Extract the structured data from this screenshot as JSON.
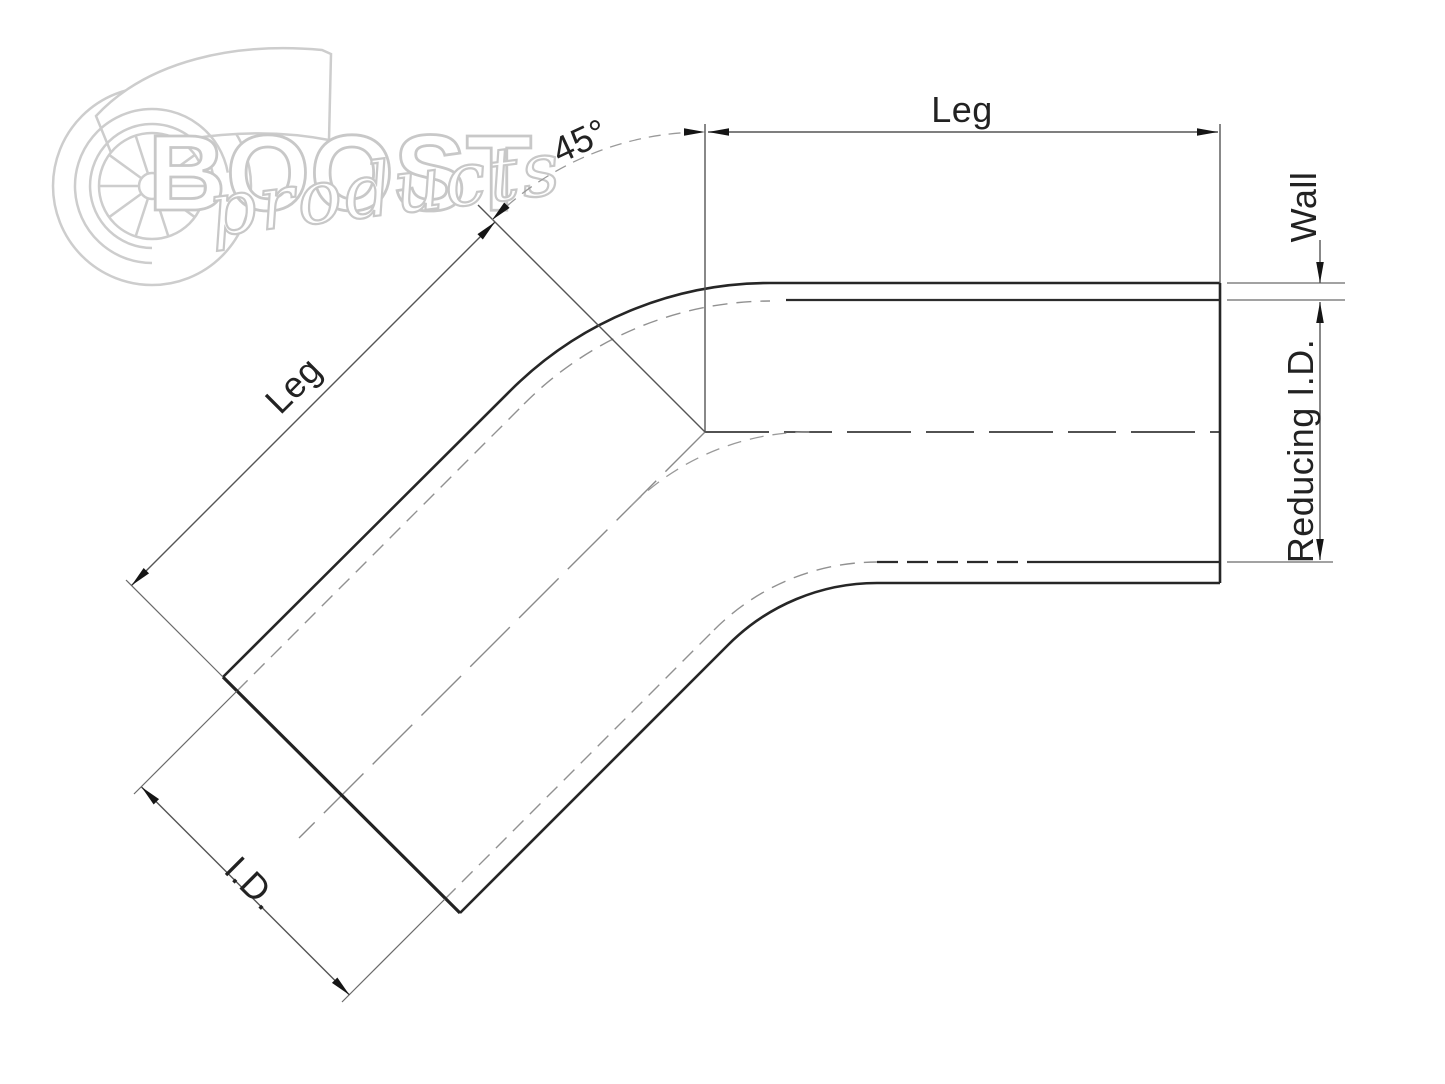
{
  "drawing": {
    "title": "45-degree reducing elbow dimension diagram",
    "labels": {
      "leg_top": "Leg",
      "leg_left": "Leg",
      "angle": "45°",
      "wall": "Wall",
      "reducing_id": "Reducing I.D.",
      "id": "I.D."
    },
    "colors": {
      "background": "#ffffff",
      "contour_line": "#262626",
      "dimension_line": "#555555",
      "hidden_line": "#919191",
      "watermark": "#cdcdcd"
    }
  },
  "watermark": {
    "brand": "BOOST",
    "brand_sub": "products"
  }
}
